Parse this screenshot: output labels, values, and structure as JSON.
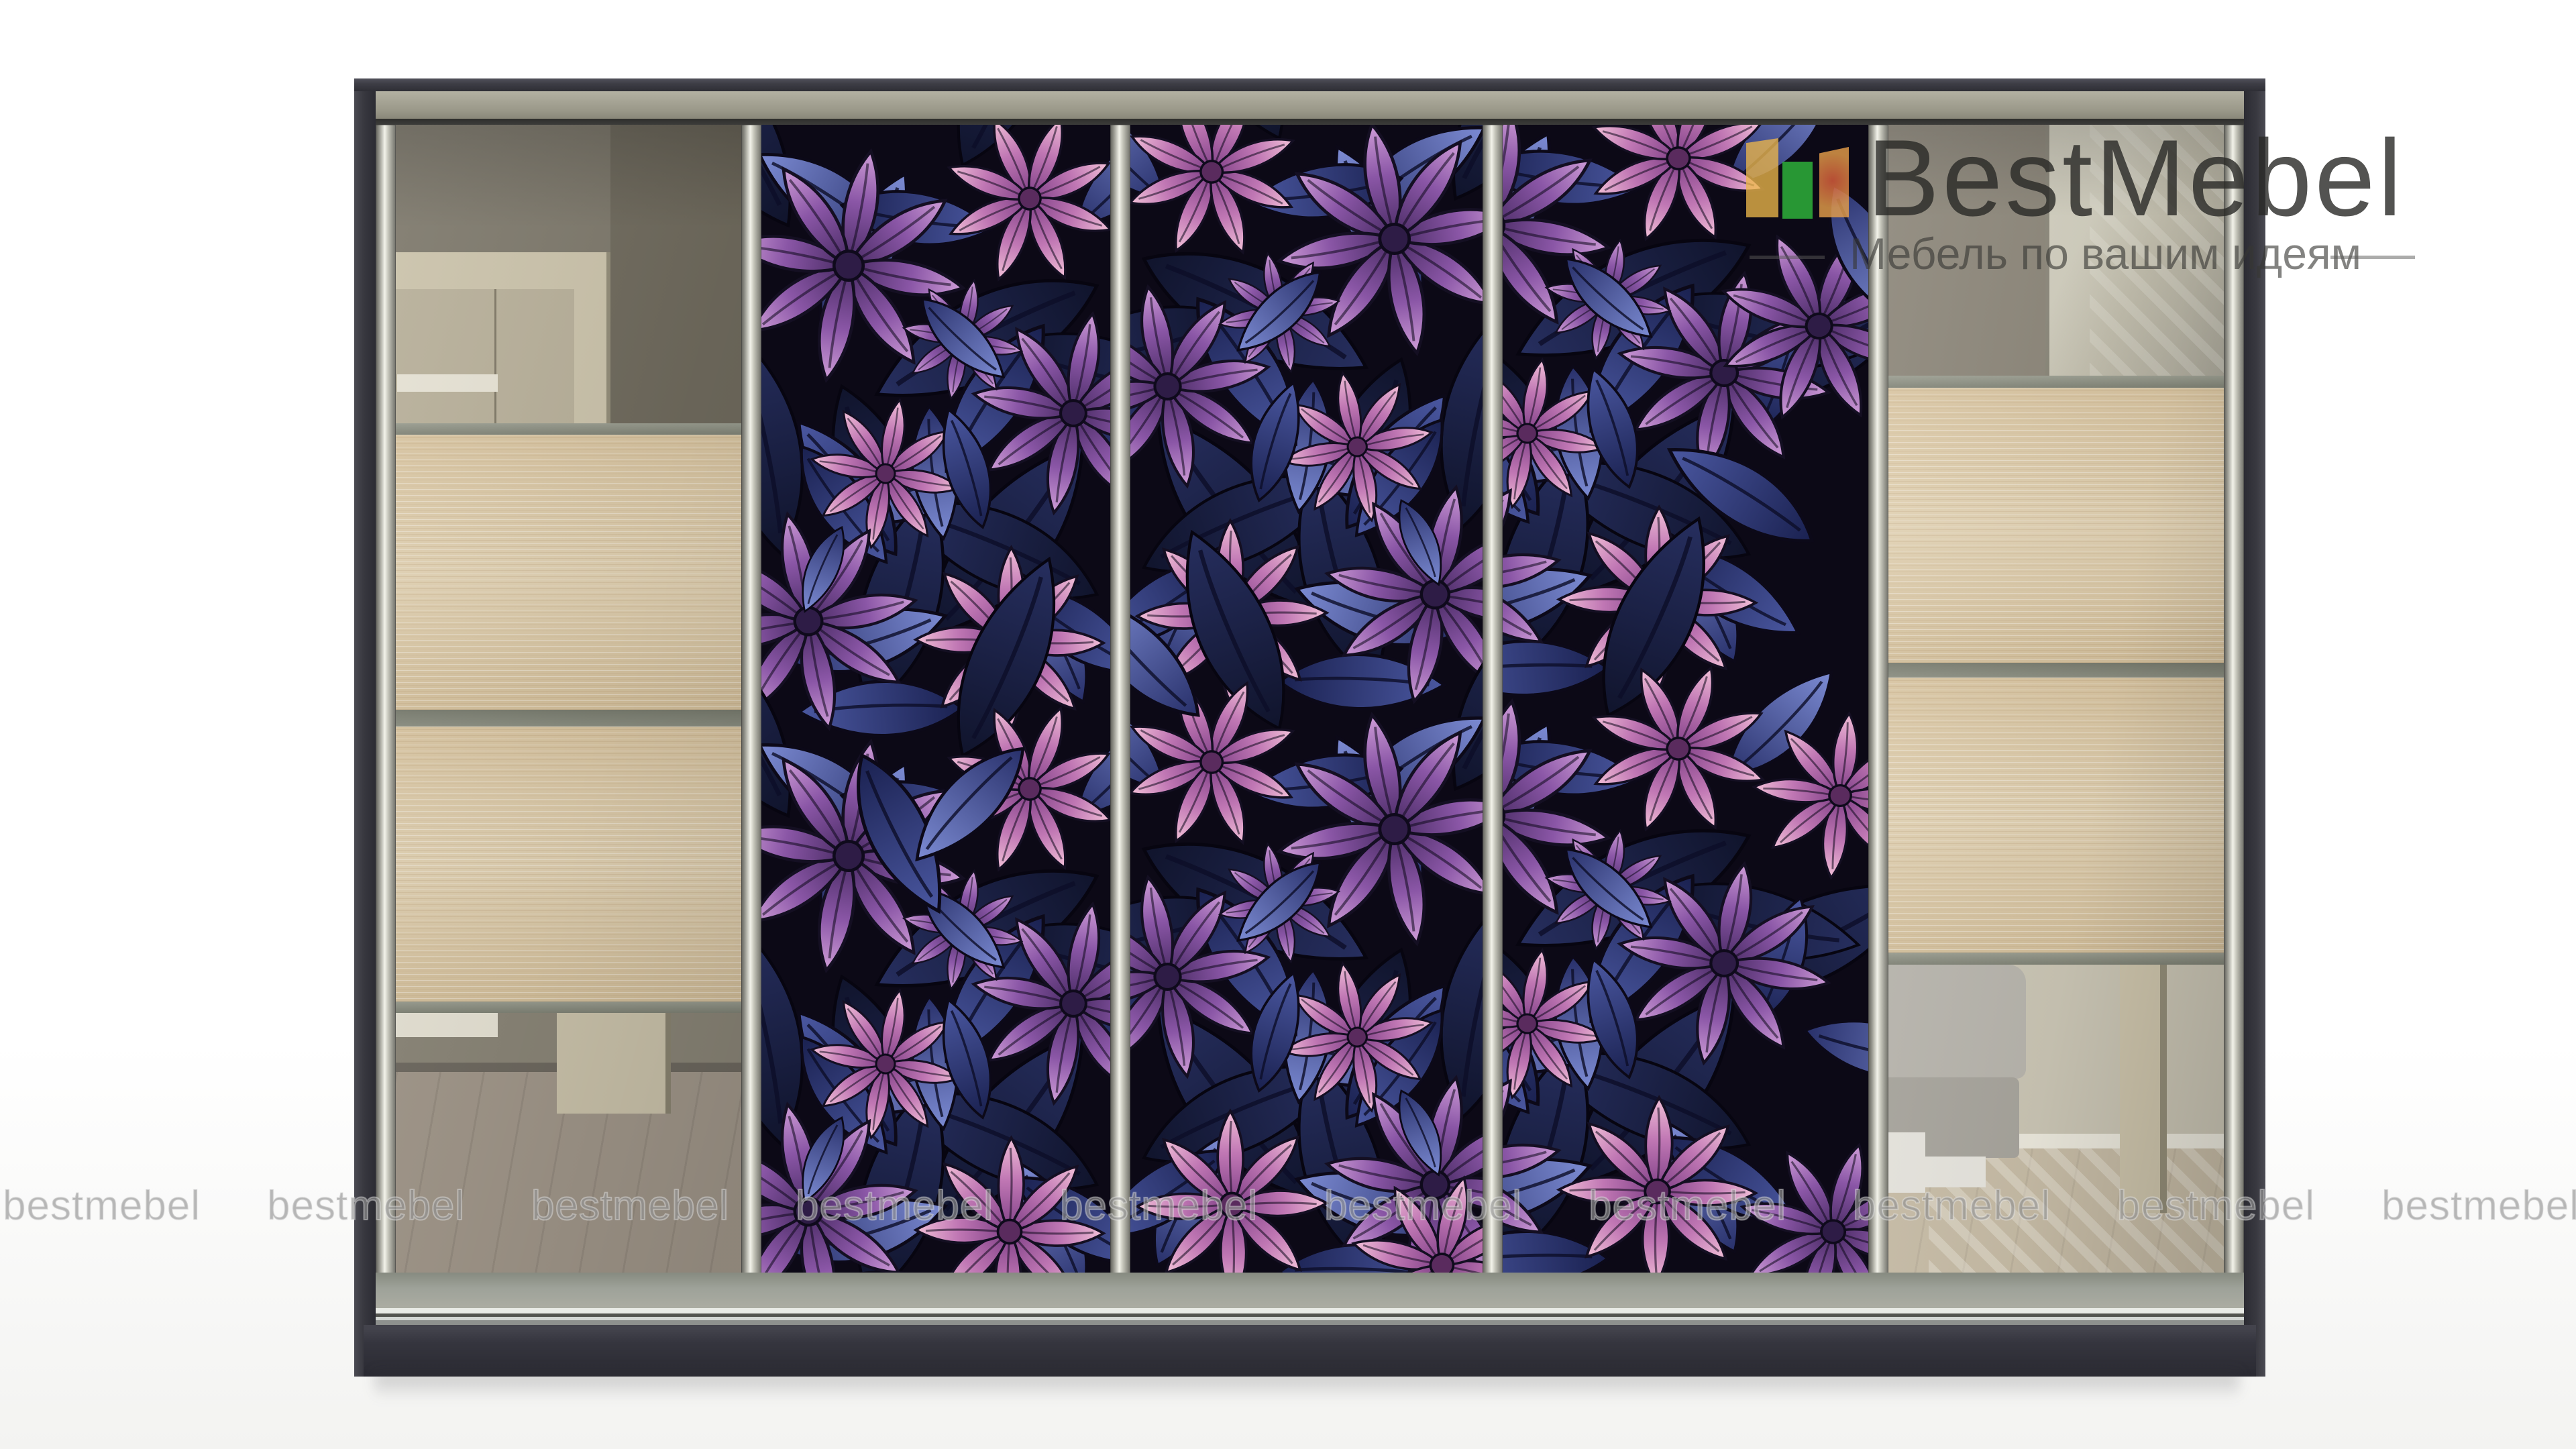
{
  "page": {
    "background": "#ffffff",
    "type": "furniture product render"
  },
  "brand": {
    "name": "BestMebel",
    "tagline": "Мебель по вашим идеям",
    "logo_icon": "three-color-bars-icon",
    "colors": {
      "bar_yellow": "#ecb64a",
      "bar_green": "#2eb03a",
      "bar_orange": "#e9a04a",
      "bar_red": "#e15f3c",
      "title_gray": "#3f3f3d",
      "tagline_gray": "#8c8c8a"
    }
  },
  "watermark": {
    "text": "bestmebel",
    "count": 10
  },
  "wardrobe": {
    "type": "five-door sliding wardrobe",
    "doors": [
      {
        "id": 1,
        "finish": "mirror with two oak panels"
      },
      {
        "id": 2,
        "finish": "purple floral print"
      },
      {
        "id": 3,
        "finish": "purple floral print"
      },
      {
        "id": 4,
        "finish": "purple floral print"
      },
      {
        "id": 5,
        "finish": "mirror with two oak panels"
      }
    ],
    "palette": {
      "frame": "#38383f",
      "frame-hi": "#4a4a52",
      "top-band": "#3e3e46",
      "rail-olive-1": "#b3b1a2",
      "rail-olive-2": "#8a887a",
      "shadow-line": "#3c3c3a",
      "chrome-hi": "#f3f3ea",
      "chrome-lo": "#6f6f68",
      "rail-gray-1": "#868a80",
      "rail-gray-2": "#abaca2",
      "track-dark": "#53544f",
      "track-light": "#e9ebe6",
      "plinth-1": "#43434c",
      "plinth-2": "#2a2a32",
      "wood-1": "#ddcba8",
      "wood-2": "#c9b28a",
      "sep-band-1": "#9a9d90",
      "sep-band-2": "#7f8275",
      "mirror-wall": "#7e796c",
      "mirror-wall-dark": "#6f6a5d",
      "mirror-wall-light": "#8a8577",
      "mirror-door-frame": "#cbc3ab",
      "mirror-door-slab": "#b8b09a",
      "mirror-white": "#e6e2d4",
      "mirror-floor": "#a1978a",
      "mirror-baseboard": "#6e6960",
      "r-wall-a": "#8a8477",
      "r-wall-b": "#c0bcab",
      "r-wall-lower": "#cbc6b5",
      "r-baseboard": "#ece9dd",
      "r-floor": "#c8bda7",
      "armchair-1": "#b8b5ad",
      "armchair-2": "#a8a59d",
      "armchair-base": "#e7e5de",
      "r-column": "#cfc6ad",
      "floral-bg": "#0c0916",
      "petal-a-base": "#472a62",
      "petal-a-mid": "#8a56a6",
      "petal-a-tip": "#cf9dd8",
      "petal-b-base": "#7e3f86",
      "petal-b-mid": "#c077b4",
      "petal-b-tip": "#f2c0d8",
      "leaf-a-1": "#28306a",
      "leaf-a-2": "#7b8ad2",
      "leaf-b-1": "#1a2150",
      "leaf-b-2": "#4a57a0",
      "leaf-d-1": "#10142c",
      "leaf-d-2": "#262e5e",
      "petal-stroke": "#140f22"
    }
  }
}
